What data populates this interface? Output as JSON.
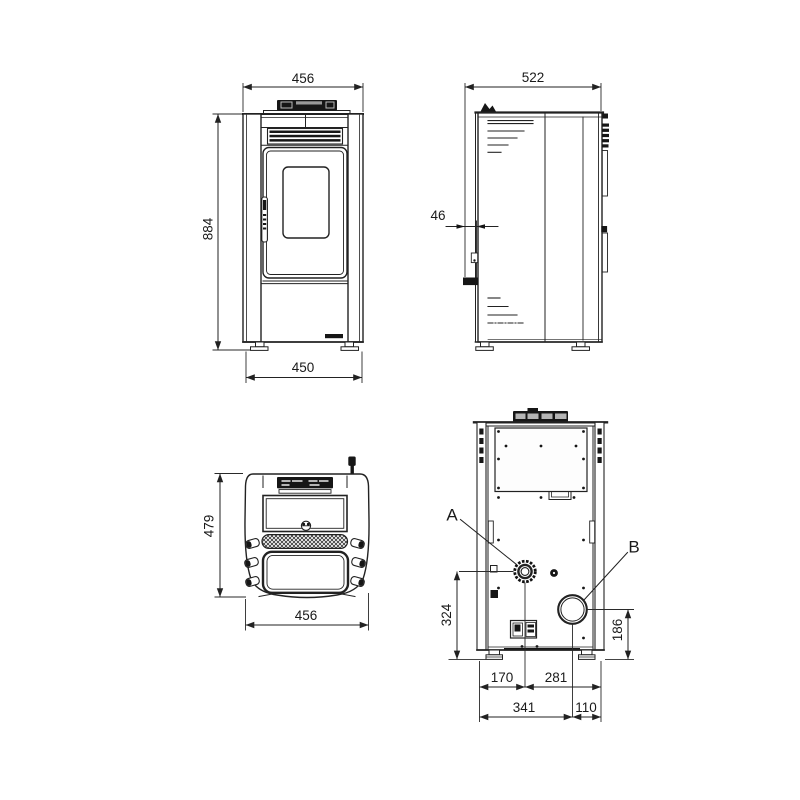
{
  "views": {
    "front": {
      "top_width": "456",
      "height": "884",
      "base_width": "450"
    },
    "side": {
      "depth": "522",
      "rear_offset": "46"
    },
    "top": {
      "depth": "479",
      "width": "456"
    },
    "rear": {
      "air_intake_label": "A",
      "flue_label": "B",
      "air_intake_height": "324",
      "flue_height": "186",
      "air_intake_from_left": "170",
      "air_intake_to_right": "281",
      "flue_from_left": "341",
      "flue_to_right": "110"
    }
  },
  "colors": {
    "line": "#222222",
    "dark_fill": "#161616",
    "background": "#ffffff"
  }
}
